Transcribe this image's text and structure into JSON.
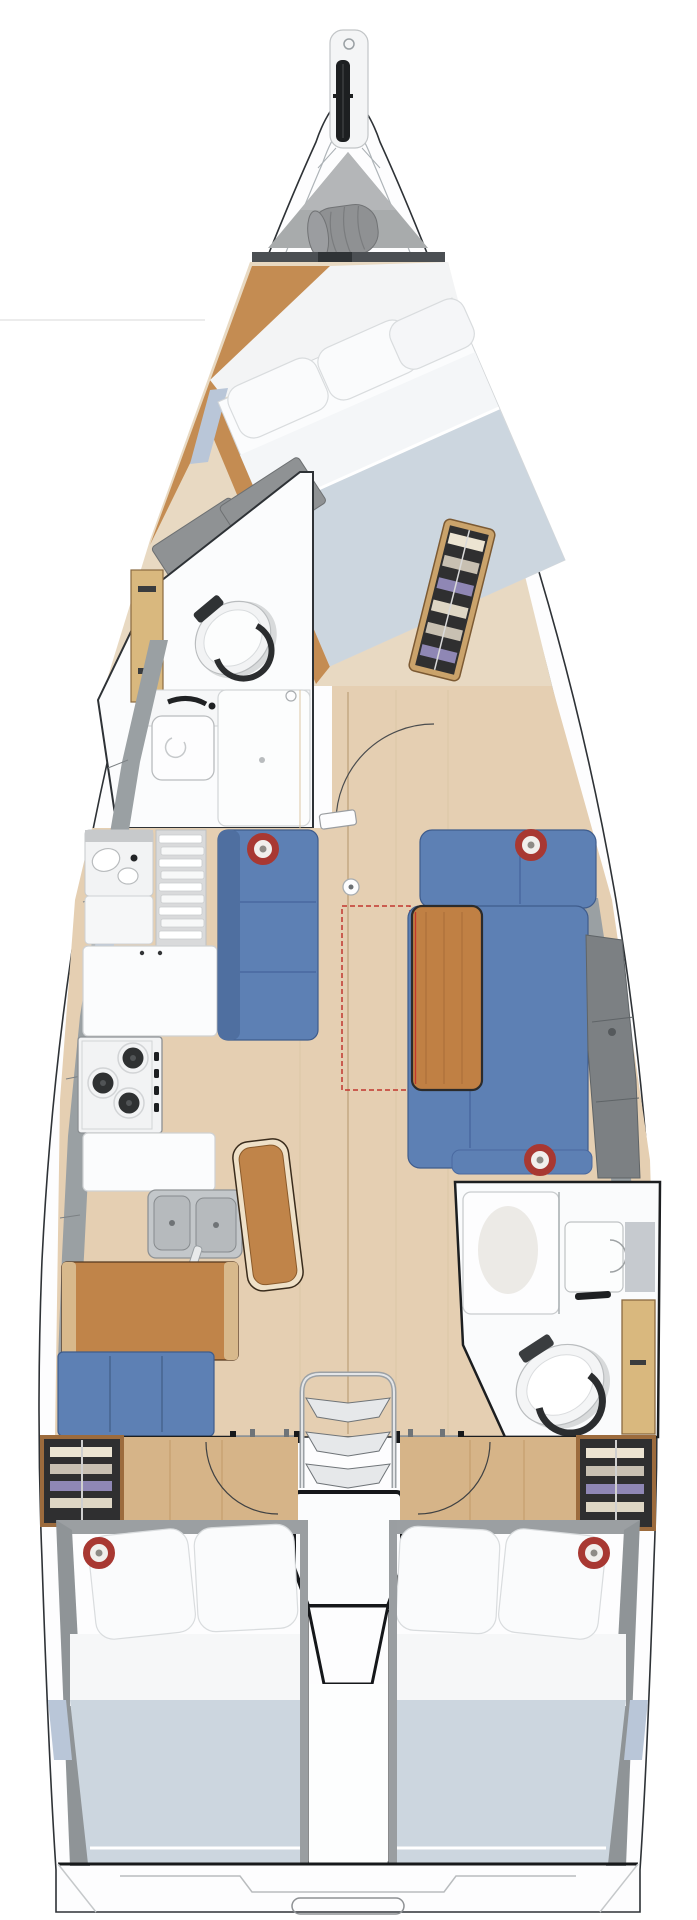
{
  "figure": {
    "type": "floor-plan",
    "subject": "sailboat-interior-layout-top-view",
    "orientation": "bow-top-stern-bottom",
    "cabins_visible": 3,
    "heads_visible": 2,
    "speaker_markers_visible": 5
  },
  "palette": {
    "page_bg": "#ffffff",
    "line_dark": "#2e3236",
    "hull_fill": "#fdfdfe",
    "liner_line": "#aeb4b8",
    "accent_blue": "#b9c6d8",
    "deck_gray": "#9aa0a3",
    "locker_gray": "#a8abac",
    "bag_gray": "#8f9193",
    "bulkhead_dark": "#4b4f53",
    "wood_orange": "#c48c52",
    "wood_sole": "#e5cfb2",
    "wood_entry": "#d6b488",
    "wood_trim": "#caa36b",
    "sole_seam": "#c5ab86",
    "upholstery_blue": "#5d80b4",
    "upholstery_blue_dark": "#4f6fa0",
    "upholstery_gray": "#8f9294",
    "backrest_gray": "#7c8083",
    "leather_brown": "#c08449",
    "table_wood": "#c08044",
    "duvet_blue": "#ccd6df",
    "pillow_white": "#fafbfc",
    "sheet_white": "#f6f7f8",
    "fixture_white": "#fbfcfd",
    "steel_gray": "#c3c7ca",
    "wood_locker": "#d9b87e",
    "wardrobe_frame": "#9c6b3d",
    "wardrobe_bg": "#2f2f30",
    "cloth_beige": "#ece4d2",
    "cloth_gray": "#c8c0b2",
    "cloth_purple": "#8f87b5",
    "cloth_cream": "#ded6c4",
    "speaker_red": "#a83832",
    "dash_red": "#c2362e",
    "stove_dark": "#2f3132",
    "engine_line": "#15171a"
  },
  "components": {
    "bow": "bowsprit-with-anchor-roller",
    "sail_locker": "gray-locker-with-sail-bag",
    "forward_cabin": "diagonal-double-berth-with-pillows-and-blue-duvet",
    "forward_head": "toilet-washbasin-shower",
    "salon_port": "straight-blue-settee",
    "salon_starboard": "l-shaped-blue-settee-with-wood-table-and-gray-backrests",
    "table_extension": "red-dashed-foldout-outline",
    "galley": "three-burner-stove-double-sink-slat-cabinet-counters",
    "chaise": "brown-leather-bench",
    "nav_station": "chart-table-with-blue-seat",
    "aft_head": "shower-stall-washbasin-toilet",
    "companionway": "three-step-ladder-over-engine-box",
    "aft_cabin_port": "double-bed-with-wardrobe",
    "aft_cabin_starboard": "double-bed-with-wardrobe",
    "stern": "transom-swim-platform-outline"
  }
}
